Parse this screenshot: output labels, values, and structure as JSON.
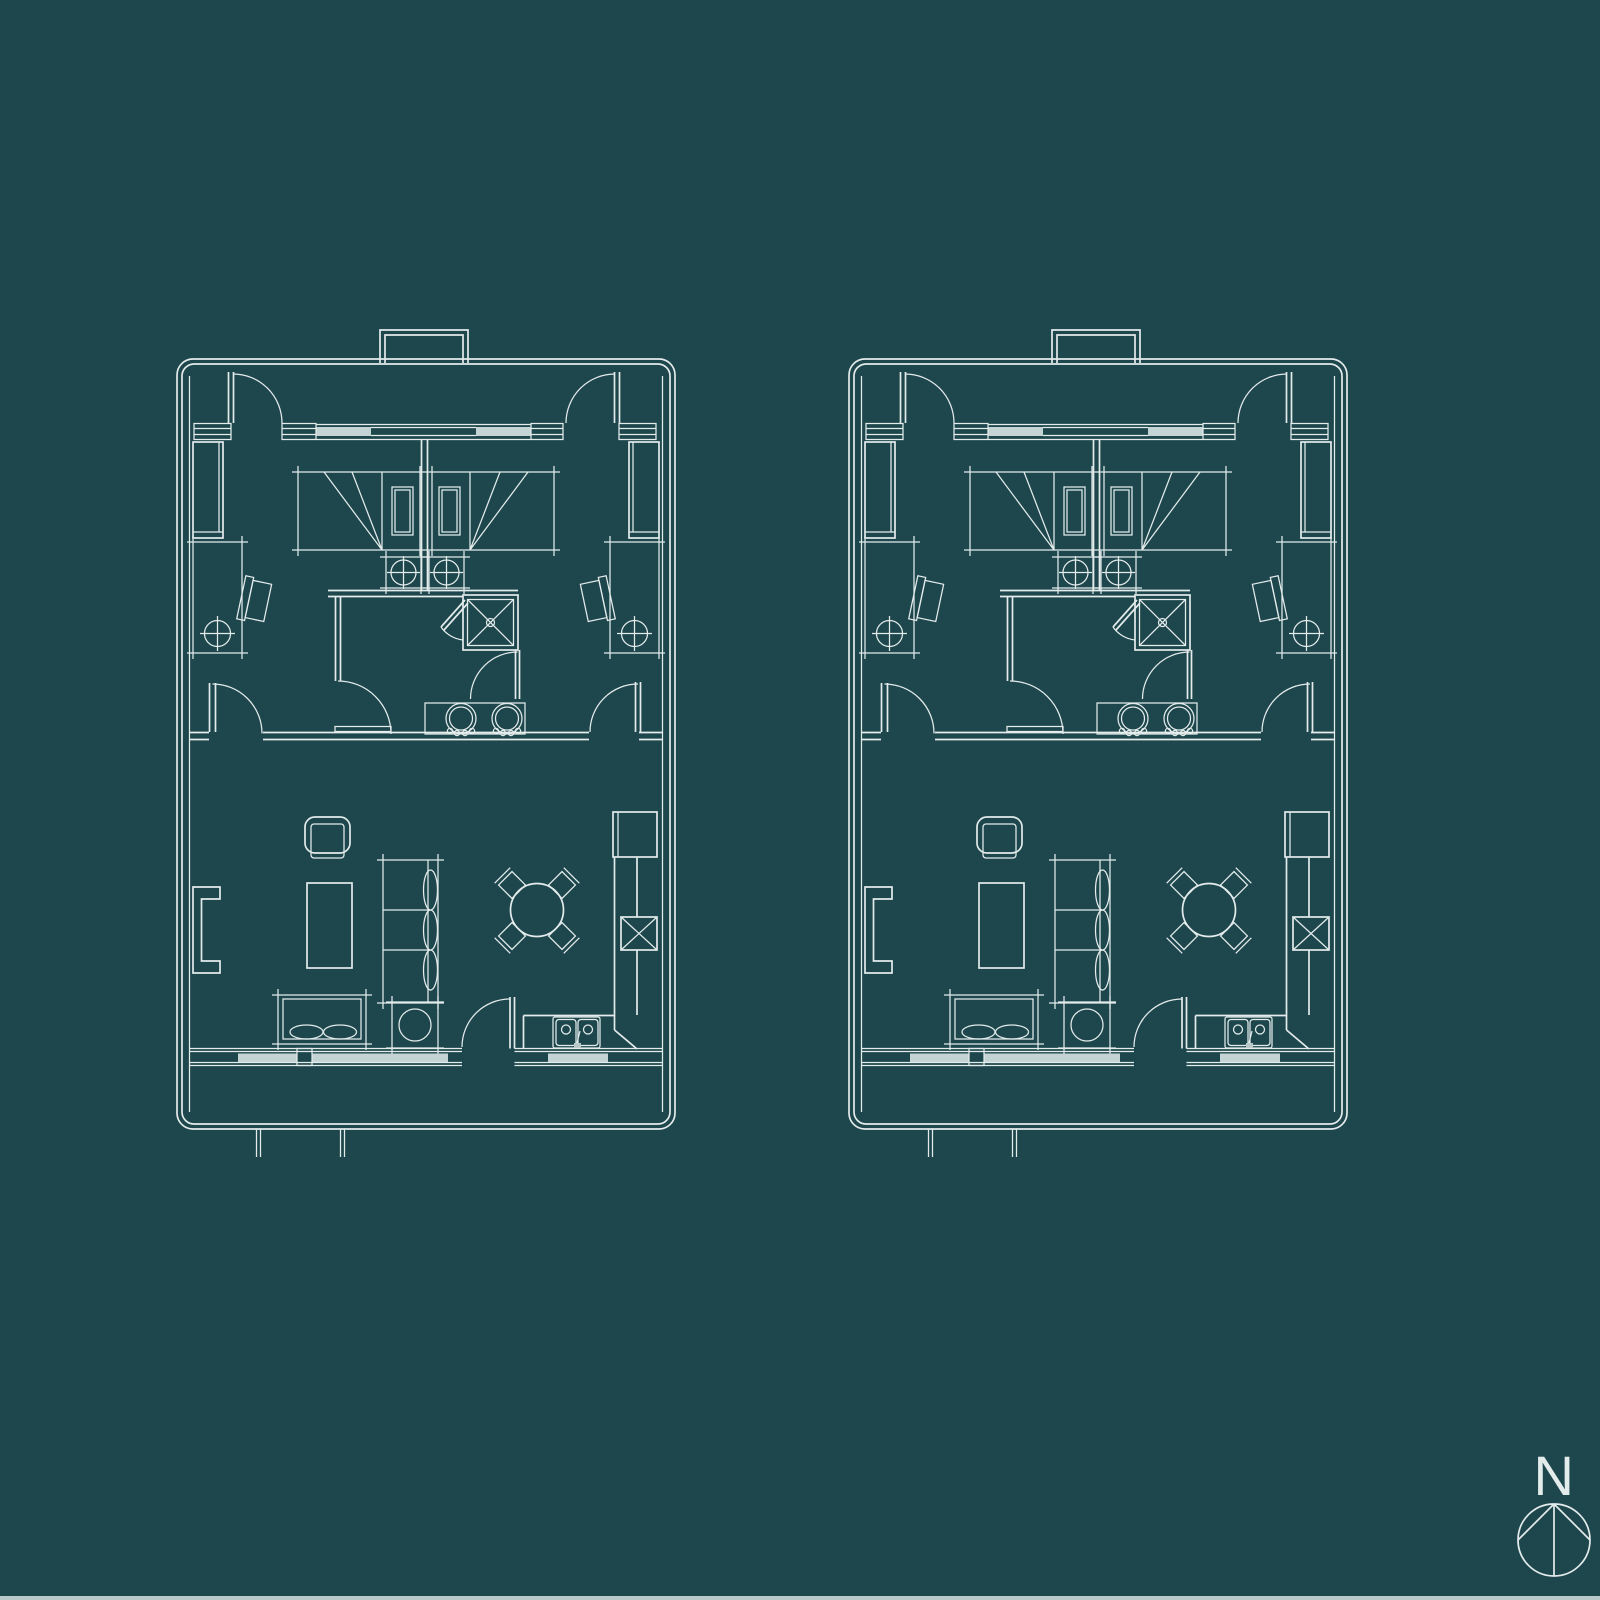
{
  "page": {
    "width_px": 1600,
    "height_px": 1600,
    "background_color": "#1e474d",
    "bottom_edge_strip_color": "#b9c8c8"
  },
  "drawing": {
    "type": "architectural-floor-plan-blueprint",
    "line_color": "#e3ebeb",
    "glazing_color": "#c4d3d4",
    "units": [
      {
        "id": "unit-left",
        "label": "floor-plan-left"
      },
      {
        "id": "unit-right",
        "label": "floor-plan-right"
      }
    ],
    "compass": {
      "label": "N",
      "symbol": "circle-with-inscribed-north-arrow"
    }
  }
}
